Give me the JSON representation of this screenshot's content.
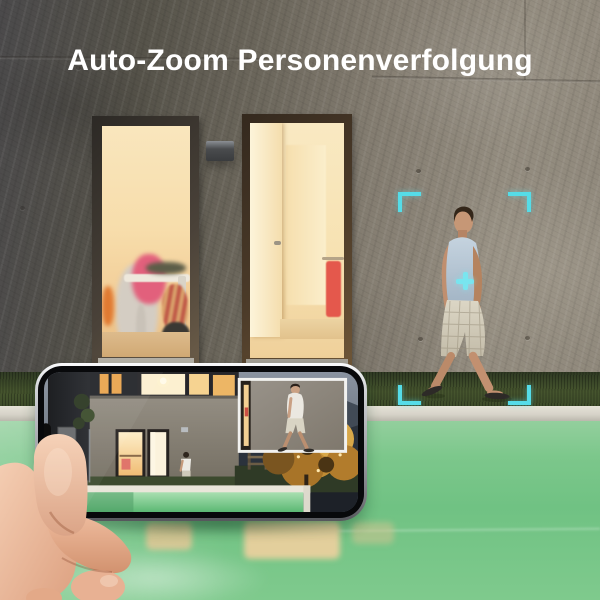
{
  "title": {
    "text": "Auto-Zoom Personenverfolgung",
    "color": "#ffffff"
  },
  "tracking_overlay": {
    "marker_icon": "corner-brackets",
    "crosshair_icon": "plus",
    "color": "#55dce8"
  },
  "palette": {
    "wall_dark": "#504e4b",
    "wall_light": "#948d80",
    "window_glow": "#f7ddab",
    "door_glow": "#f7e2b2",
    "grass_green": "#42512c",
    "pool_coping": "#d5d2c7",
    "pool_water": "#78c688",
    "water_reflection": "#e0cd9b",
    "dusk_sky": "#6b7582",
    "phone_frame": "#c9cbcf",
    "phone_bezel": "#08090b",
    "hand_skin": "#e8b79b",
    "shirt_blue": "#b9c8d6"
  }
}
